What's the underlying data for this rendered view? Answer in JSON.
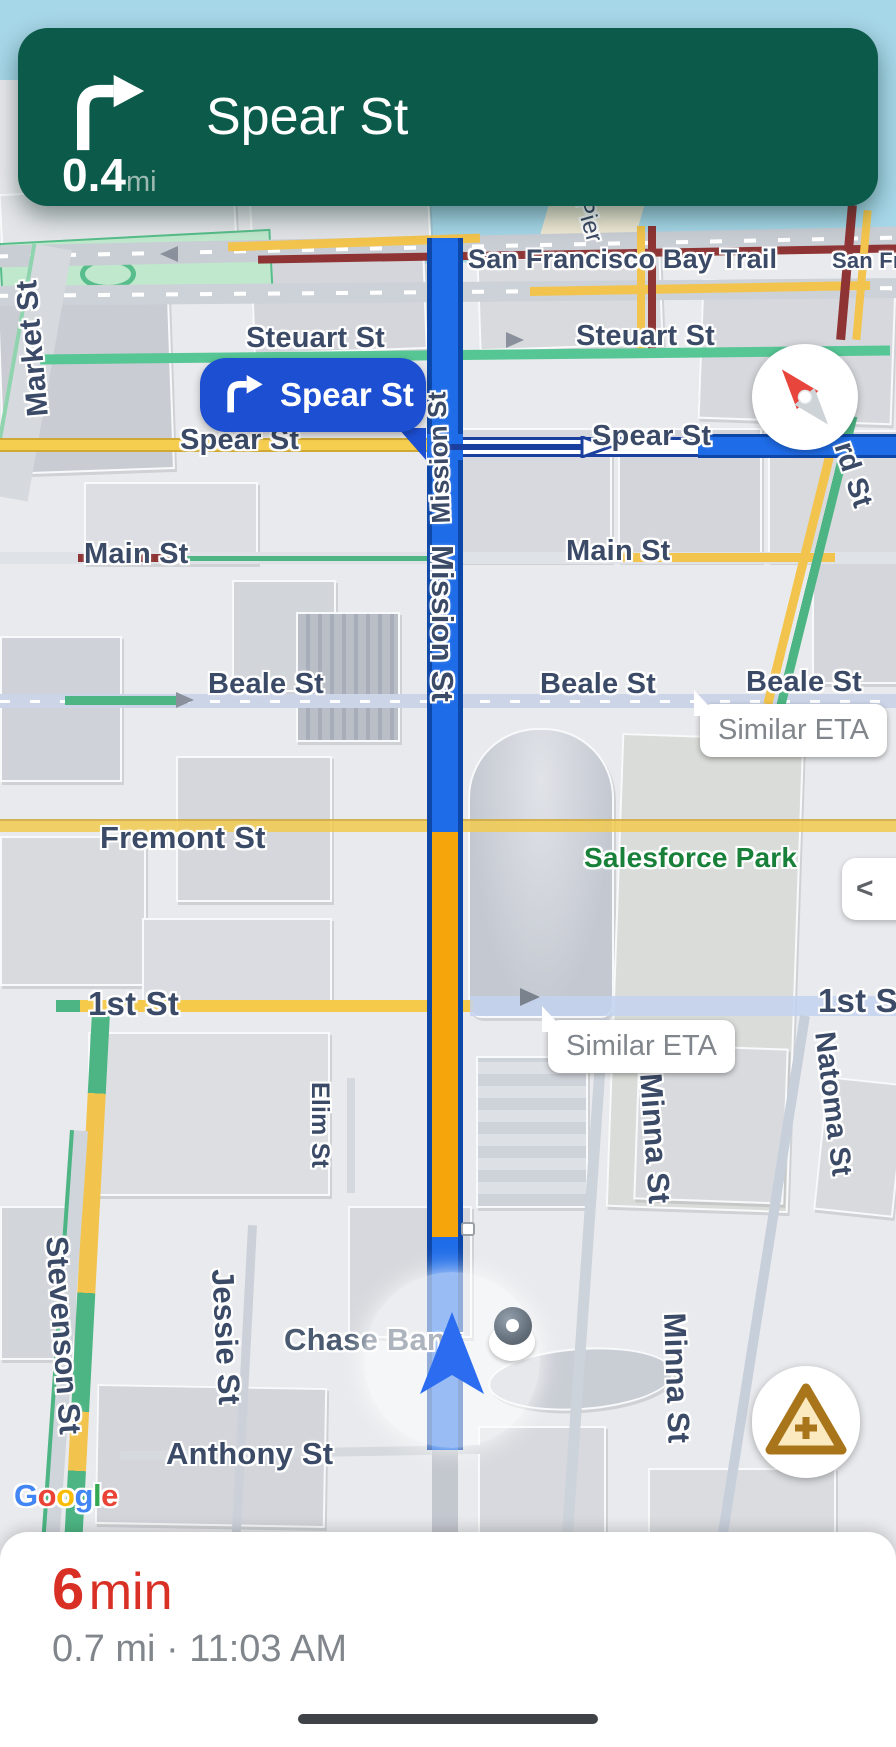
{
  "colors": {
    "banner_bg": "#0c5a4a",
    "route_blue": "#1e6ce8",
    "route_border": "#0d47a8",
    "route_orange": "#f6a60b",
    "callout_blue": "#1d4fd3",
    "eta_red": "#d93025",
    "water": "#a6d7e8",
    "map_bg": "#e9eaed",
    "label_navy": "#3b4a66",
    "muted_gray": "#80868b",
    "park_green": "#188038",
    "road_yellow": "#f2c44d",
    "road_darkred": "#8e3434",
    "road_green": "#4db583",
    "sheet_handle": "#3f4348"
  },
  "banner": {
    "primary": "Spear St",
    "distance": "0.4",
    "unit": "mi",
    "icon": "turn-right"
  },
  "maneuver_callout": {
    "label": "Spear St",
    "icon": "turn-right"
  },
  "callouts": {
    "similar_eta": "Similar ETA"
  },
  "streets": {
    "market": "Market St",
    "steuart": "Steuart St",
    "spear": "Spear St",
    "main": "Main St",
    "beale": "Beale St",
    "fremont": "Fremont St",
    "first": "1st St",
    "first_partial": "1st S",
    "mission": "Mission St",
    "minna": "Minna St",
    "natoma": "Natoma St",
    "elim": "Elim St",
    "jessie": "Jessie St",
    "stevenson": "Stevenson St",
    "anthony": "Anthony St",
    "howard_partial": "rd St",
    "pier_partial": "Pier",
    "bay_trail": "San Francisco Bay Trail",
    "bay_trail_partial": "San Fra"
  },
  "pois": {
    "chase_bank": "Chase Bank",
    "salesforce_park": "Salesforce Park"
  },
  "google_letters": [
    {
      "ch": "G",
      "color": "#4285F4"
    },
    {
      "ch": "o",
      "color": "#EA4335"
    },
    {
      "ch": "o",
      "color": "#FBBC05"
    },
    {
      "ch": "g",
      "color": "#4285F4"
    },
    {
      "ch": "l",
      "color": "#34A853"
    },
    {
      "ch": "e",
      "color": "#EA4335"
    }
  ],
  "bottom_sheet": {
    "eta_value": "6",
    "eta_unit": "min",
    "details": "0.7 mi · 11:03 AM"
  },
  "controls": {
    "collapse": "<"
  },
  "icons": {
    "maneuver": "turn-right-icon",
    "compass": "compass-needle-icon",
    "report": "report-incident-icon",
    "location": "navigation-arrow-icon",
    "pin": "map-pin-icon"
  }
}
